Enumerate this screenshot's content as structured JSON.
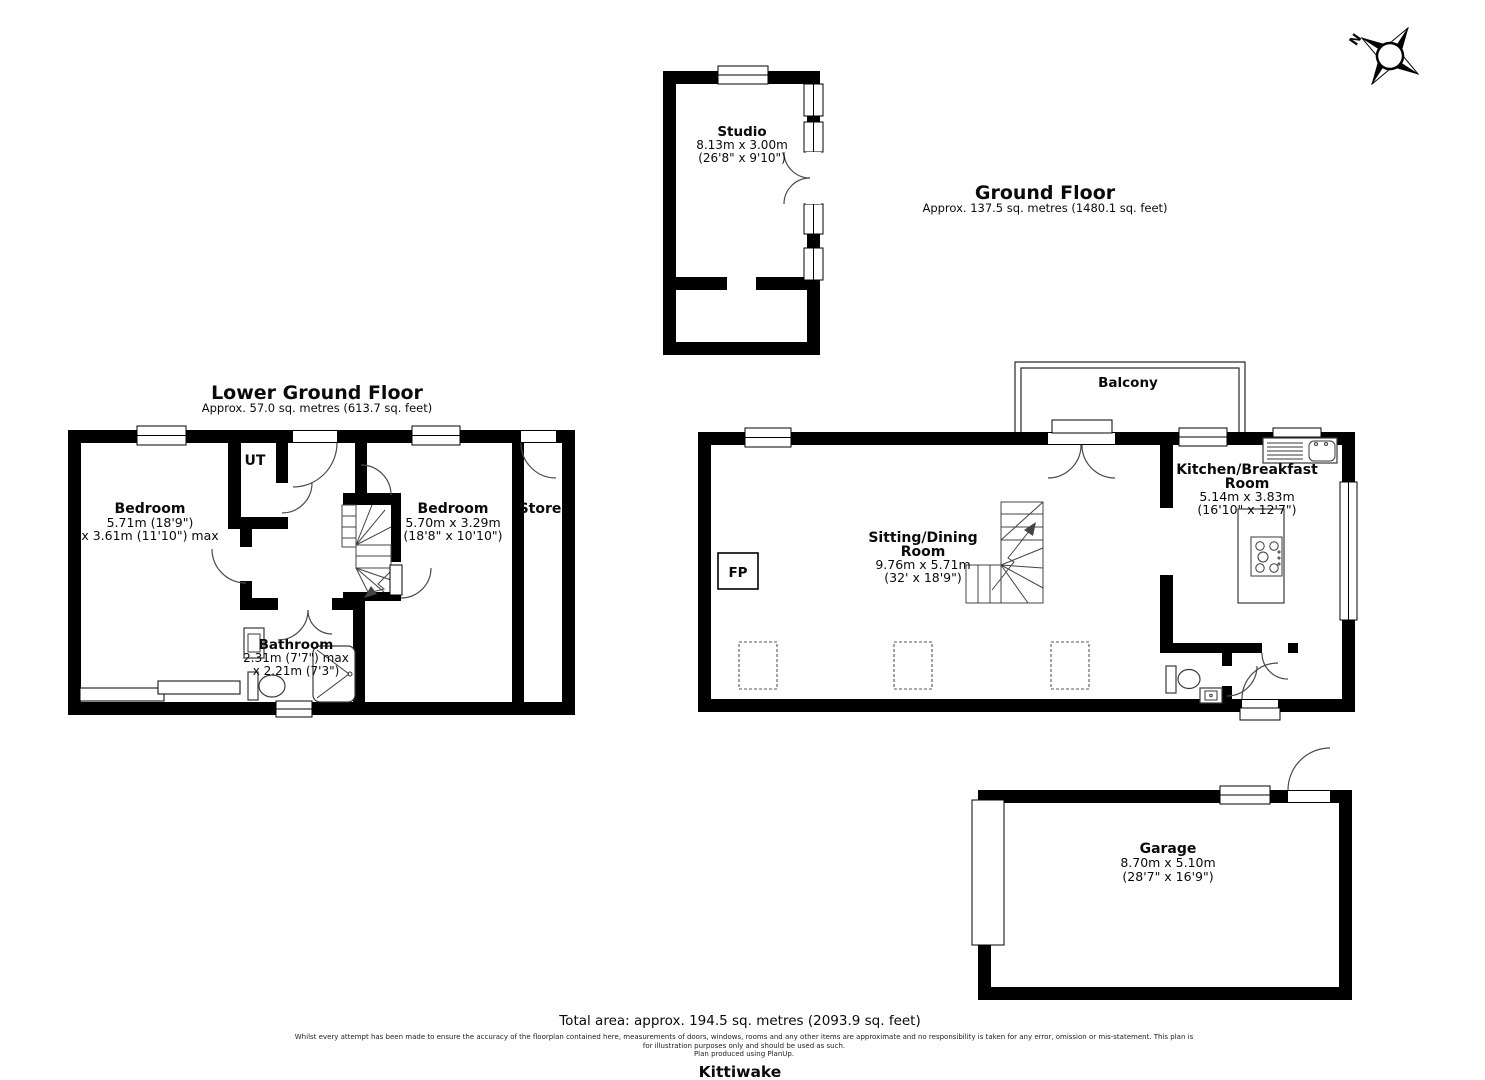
{
  "property": {
    "name": "Kittiwake"
  },
  "compass": {
    "north_label": "N"
  },
  "floors": {
    "lower_ground": {
      "title": "Lower Ground Floor",
      "subtitle": "Approx. 57.0 sq. metres (613.7 sq. feet)"
    },
    "ground": {
      "title": "Ground Floor",
      "subtitle": "Approx. 137.5 sq. metres (1480.1 sq. feet)"
    }
  },
  "rooms": {
    "studio": {
      "name": "Studio",
      "dim_line1": "8.13m x 3.00m",
      "dim_line2": "(26'8\" x 9'10\")"
    },
    "bedroom_1": {
      "name": "Bedroom",
      "dim_line1": "5.71m (18'9\")",
      "dim_line2": "x 3.61m (11'10\") max"
    },
    "utility": {
      "name": "UT"
    },
    "bedroom_2": {
      "name": "Bedroom",
      "dim_line1": "5.70m x 3.29m",
      "dim_line2": "(18'8\" x 10'10\")"
    },
    "store": {
      "name": "Store"
    },
    "bathroom": {
      "name": "Bathroom",
      "dim_line1": "2.31m (7'7\") max",
      "dim_line2": "x 2.21m (7'3\")"
    },
    "sitting_dining": {
      "name_line1": "Sitting/Dining",
      "name_line2": "Room",
      "dim_line1": "9.76m x 5.71m",
      "dim_line2": "(32' x 18'9\")"
    },
    "kitchen": {
      "name_line1": "Kitchen/Breakfast",
      "name_line2": "Room",
      "dim_line1": "5.14m x 3.83m",
      "dim_line2": "(16'10\" x 12'7\")"
    },
    "balcony": {
      "name": "Balcony"
    },
    "fireplace": {
      "label": "FP"
    },
    "garage": {
      "name": "Garage",
      "dim_line1": "8.70m x 5.10m",
      "dim_line2": "(28'7\" x 16'9\")"
    }
  },
  "footer": {
    "total_area": "Total area: approx. 194.5 sq. metres (2093.9 sq. feet)",
    "disclaimer_line1": "Whilst every attempt has been made to ensure the accuracy of the floorplan contained here, measurements of doors, windows, rooms and any other items are approximate and no responsibility is taken for any error, omission or mis-statement. This plan is",
    "disclaimer_line2": "for illustration purposes only and should be used as such.",
    "disclaimer_line3": "Plan produced using PlanUp."
  },
  "colors": {
    "wall": "#000000",
    "background": "#ffffff"
  }
}
